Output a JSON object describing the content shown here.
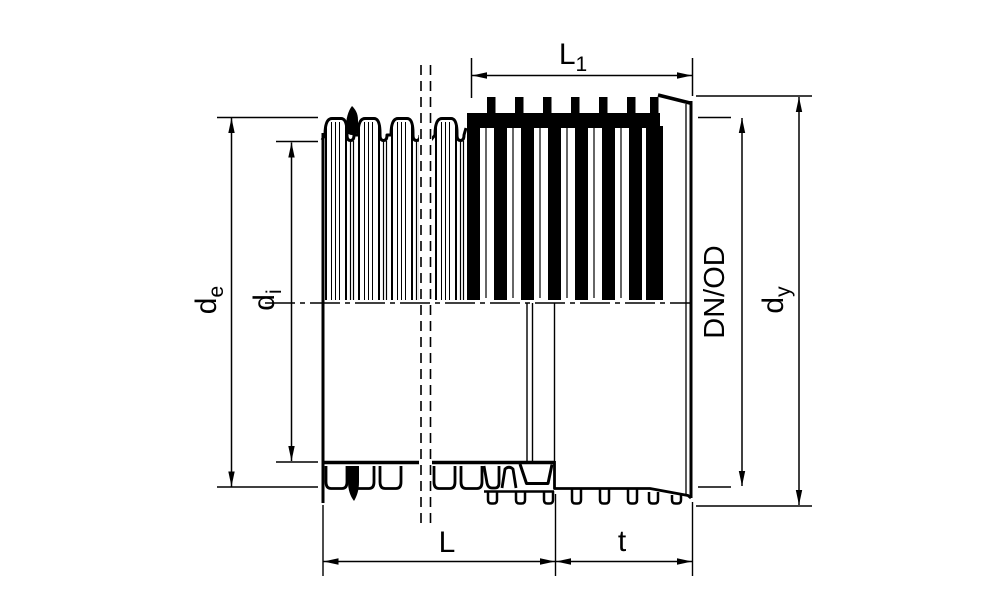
{
  "figure": {
    "kind": "technical-dimension-drawing",
    "view": "half-section of corrugated pipe with integral socket"
  },
  "labels": {
    "L1": {
      "main": "L",
      "sub": "1"
    },
    "de": {
      "main": "d",
      "sub": "e"
    },
    "di": {
      "main": "d",
      "sub": "i"
    },
    "dnod": {
      "text": "DN/OD"
    },
    "dy": {
      "main": "d",
      "sub": "y"
    },
    "L": {
      "text": "L"
    },
    "t": {
      "text": "t"
    }
  },
  "colors": {
    "line": "#000000",
    "background": "#ffffff"
  }
}
